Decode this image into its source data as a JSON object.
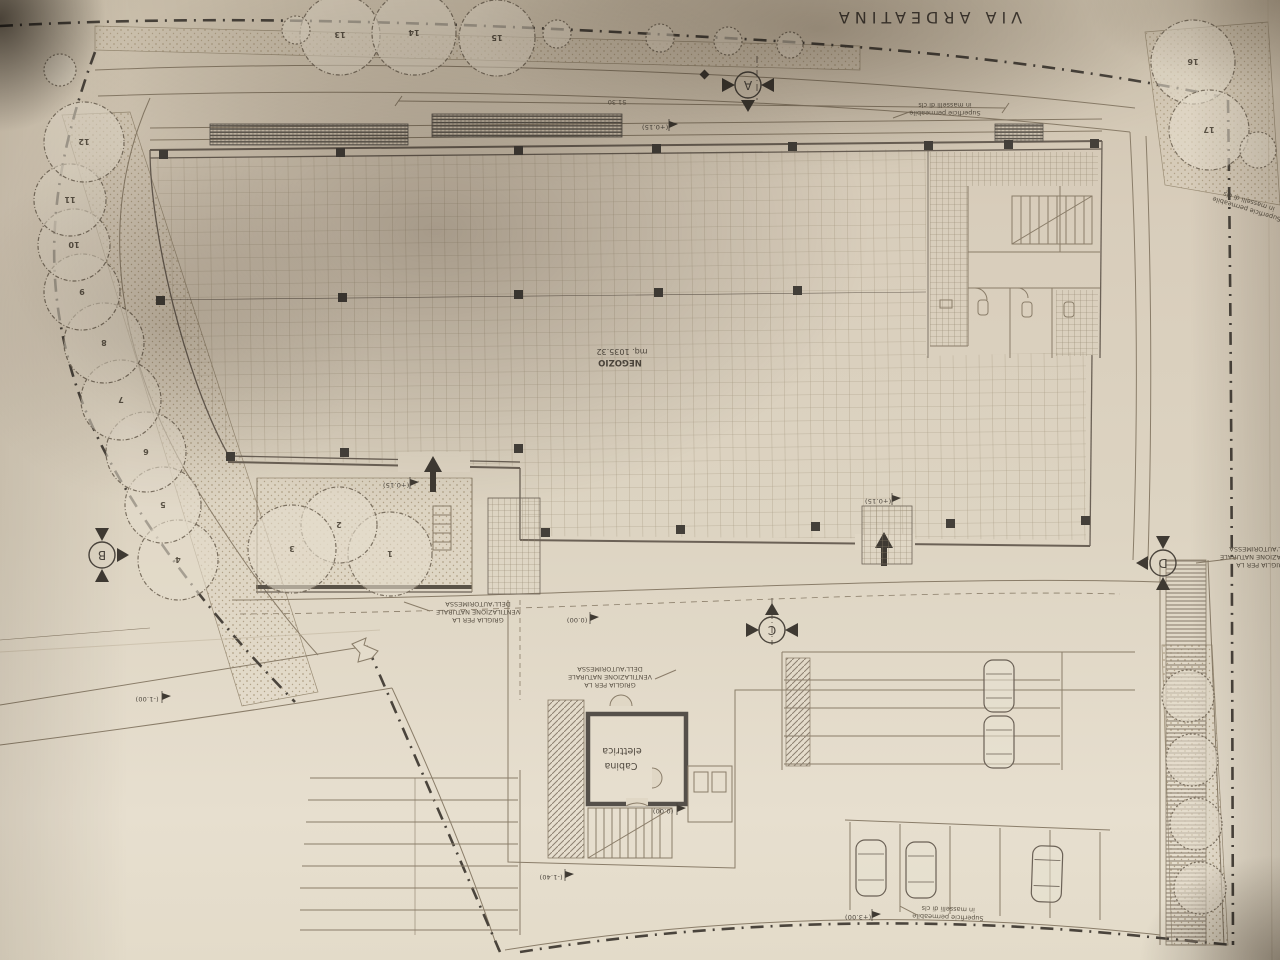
{
  "street": {
    "name": "VIA ARDEATINA"
  },
  "building": {
    "name": "NEGOZIO",
    "area": "mq. 1035.32"
  },
  "rooms": {
    "cabina_line1": "Cabina",
    "cabina_line2": "elettrica"
  },
  "labels": {
    "grille_l1": "GRIGLIA PER LA",
    "grille_l2": "VENTILAZIONE NATURALE",
    "grille_l3": "DELL'AUTORIMESSA",
    "permeable_l1": "Superficie permeabile",
    "permeable_l2": "in masselli di cls"
  },
  "dimensions": {
    "top_width": "51.30"
  },
  "levels": {
    "plaza": "(+0.15)",
    "entrance_north": "(+0.15)",
    "entrance_south": "(+0.15)",
    "yard": "(0.00)",
    "stairs": "(0.00)",
    "ramp_bottom": "(-1.40)",
    "road_west": "(-1.00)",
    "road_south": "(+3.00)"
  },
  "sections": {
    "a": "A",
    "b": "B",
    "c": "C",
    "d": "D"
  },
  "trees": [
    {
      "label": "1"
    },
    {
      "label": "2"
    },
    {
      "label": "3"
    },
    {
      "label": "4"
    },
    {
      "label": "5"
    },
    {
      "label": "6"
    },
    {
      "label": "7"
    },
    {
      "label": "8"
    },
    {
      "label": "9"
    },
    {
      "label": "10"
    },
    {
      "label": "11"
    },
    {
      "label": "12"
    },
    {
      "label": "13"
    },
    {
      "label": "14"
    },
    {
      "label": "15"
    },
    {
      "label": "16"
    },
    {
      "label": "17"
    }
  ]
}
